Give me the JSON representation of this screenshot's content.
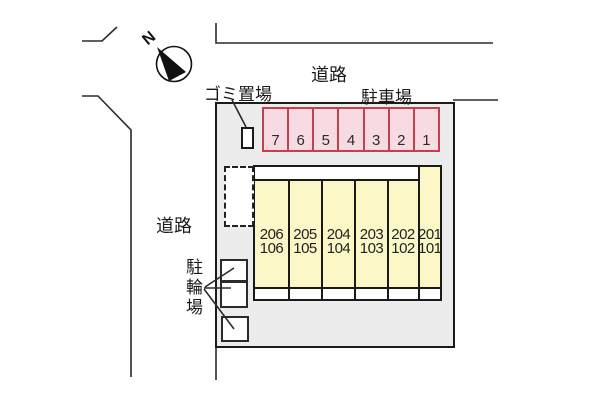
{
  "labels": {
    "road_top": "道路",
    "road_left": "道路",
    "parking_area": "駐車場",
    "garbage_area": "ゴミ置場",
    "bicycle_area": "駐輪場",
    "north": "N"
  },
  "parking_stalls": [
    "7",
    "6",
    "5",
    "4",
    "3",
    "2",
    "1"
  ],
  "building_units": [
    {
      "upper": "206",
      "lower": "106"
    },
    {
      "upper": "205",
      "lower": "105"
    },
    {
      "upper": "204",
      "lower": "104"
    },
    {
      "upper": "203",
      "lower": "103"
    },
    {
      "upper": "202",
      "lower": "102"
    },
    {
      "upper": "201",
      "lower": "101"
    }
  ],
  "colors": {
    "site_fill": "#ECECEC",
    "parking_fill": "#F8DBE2",
    "parking_border": "#C2414F",
    "building_fill": "#FBF7C6",
    "line": "#1A1A1A"
  }
}
